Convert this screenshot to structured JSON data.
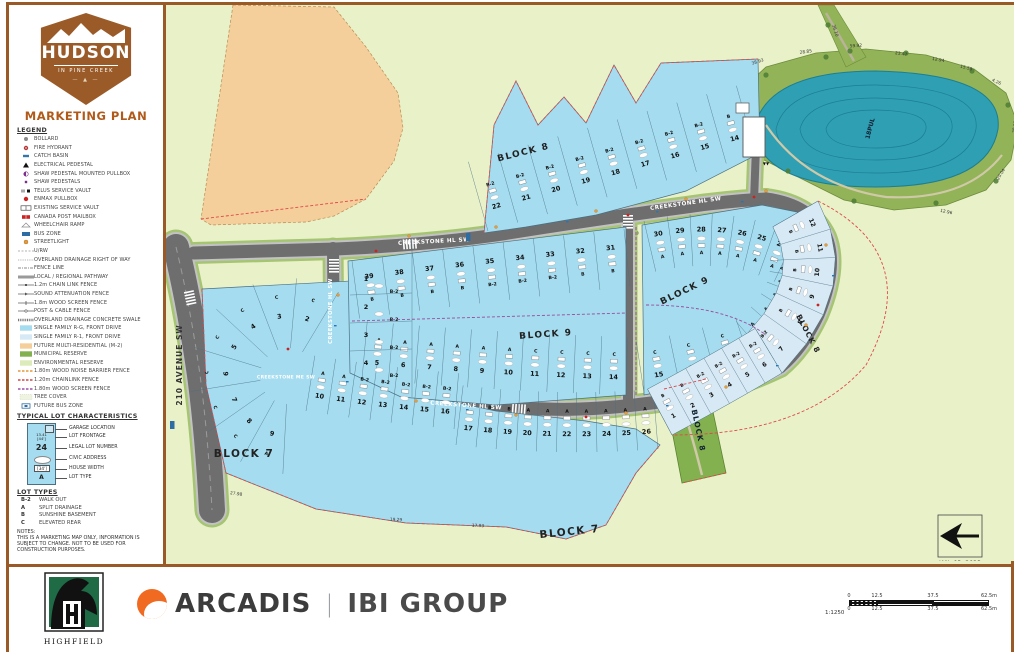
{
  "title_block": {
    "logo_name": "HUDSON",
    "logo_tagline": "IN PINE CREEK",
    "logo_est": "EST&nbsp; 2018",
    "plan_title": "MARKETING PLAN"
  },
  "colors": {
    "frame": "#9a5a28",
    "accent_title": "#b05a1a",
    "badge": "#9a5b28",
    "r_g_lot": "#a5dcef",
    "r_1_lot": "#d6e9f4",
    "m2_future": "#f4cf9b",
    "municipal_reserve": "#84b150",
    "environmental_reserve": "#e9f1c9",
    "pond_water": "#2f9fb4",
    "pond_ring": "#92b357",
    "road": "#6e6e6e",
    "fence_red": "#e04848",
    "fence_purple": "#9a4d9e",
    "bus_blue": "#2e6da4",
    "streetlight": "#e39b3d"
  },
  "legend": {
    "heading": "LEGEND",
    "items": [
      {
        "icon": "bollard-icon",
        "label": "BOLLARD"
      },
      {
        "icon": "fire-hydrant-icon",
        "label": "FIRE HYDRANT"
      },
      {
        "icon": "catch-basin-icon",
        "label": "CATCH BASIN"
      },
      {
        "icon": "electrical-pedestal-icon",
        "label": "ELECTRICAL PEDESTAL"
      },
      {
        "icon": "shaw-pullbox-icon",
        "label": "SHAW PEDESTAL MOUNTED PULLBOX"
      },
      {
        "icon": "shaw-pedestal-icon",
        "label": "SHAW PEDESTALS"
      },
      {
        "icon": "telus-vault-icon",
        "label": "TELUS SERVICE VAULT"
      },
      {
        "icon": "enmax-pullbox-icon",
        "label": "ENMAX PULLBOX"
      },
      {
        "icon": "existing-vault-icon",
        "label": "EXISTING SERVICE VAULT"
      },
      {
        "icon": "canada-post-icon",
        "label": "CANADA POST MAILBOX"
      },
      {
        "icon": "wheelchair-ramp-icon",
        "label": "WHEELCHAIR RAMP"
      },
      {
        "icon": "bus-zone-icon",
        "label": "BUS ZONE"
      },
      {
        "icon": "streetlight-icon",
        "label": "STREETLIGHT"
      },
      {
        "icon": "urw-line-icon",
        "label": "U/RW"
      },
      {
        "icon": "overland-drainage-icon",
        "label": "OVERLAND DRAINAGE RIGHT OF WAY"
      },
      {
        "icon": "fence-line-icon",
        "label": "FENCE LINE"
      },
      {
        "icon": "pathway-icon",
        "label": "LOCAL / REGIONAL PATHWAY"
      },
      {
        "icon": "chain-link-fence-icon",
        "label": "1.2m CHAIN LINK FENCE"
      },
      {
        "icon": "sound-fence-icon",
        "label": "SOUND ATTENUATION FENCE"
      },
      {
        "icon": "wood-screen-fence-icon",
        "label": "1.8m WOOD SCREEN FENCE"
      },
      {
        "icon": "post-cable-fence-icon",
        "label": "POST & CABLE FENCE"
      },
      {
        "icon": "concrete-swale-icon",
        "label": "OVERLAND DRAINAGE CONCRETE SWALE"
      },
      {
        "icon": "swatch-rg",
        "label": "SINGLE FAMILY R-G, FRONT DRIVE"
      },
      {
        "icon": "swatch-r1",
        "label": "SINGLE FAMILY R-1, FRONT DRIVE"
      },
      {
        "icon": "swatch-m2",
        "label": "FUTURE MULTI-RESIDENTIAL (M-2)"
      },
      {
        "icon": "swatch-mr",
        "label": "MUNICIPAL RESERVE"
      },
      {
        "icon": "swatch-er",
        "label": "ENVIRONMENTAL RESERVE"
      },
      {
        "icon": "noise-barrier-icon",
        "label": "1.80m WOOD NOISE BARRIER FENCE"
      },
      {
        "icon": "chainlink-120-icon",
        "label": "1.20m CHAINLINK FENCE"
      },
      {
        "icon": "wood-screen-180-icon",
        "label": "1.80m WOOD SCREEN FENCE"
      },
      {
        "icon": "tree-cover-icon",
        "label": "TREE COVER"
      },
      {
        "icon": "future-bus-icon",
        "label": "FUTURE BUS ZONE"
      }
    ]
  },
  "typical_lot": {
    "heading": "TYPICAL LOT CHARACTERISTICS",
    "sample": {
      "frontage": "13.41",
      "frontage_ft": "[44']",
      "lot_number": "24",
      "width": "[34']",
      "type": "A"
    },
    "callouts": [
      "GARAGE LOCATION",
      "LOT FRONTAGE",
      "LEGAL LOT NUMBER",
      "CIVIC ADDRESS",
      "HOUSE WIDTH",
      "LOT TYPE"
    ]
  },
  "lot_types": {
    "heading": "LOT TYPES",
    "items": [
      {
        "code": "B-2",
        "label": "WALK OUT"
      },
      {
        "code": "A",
        "label": "SPLIT DRAINAGE"
      },
      {
        "code": "B",
        "label": "SUNSHINE BASEMENT"
      },
      {
        "code": "C",
        "label": "ELEVATED REAR"
      }
    ]
  },
  "notes": {
    "heading": "NOTES:",
    "text": "THIS IS A MARKETING MAP ONLY, INFORMATION IS SUBJECT TO CHANGE. NOT TO BE USED FOR CONSTRUCTION PURPOSES."
  },
  "footer": {
    "highfield": "HIGHFIELD",
    "arcadis": "ARCADIS",
    "divider": "|",
    "ibi": "IBI GROUP",
    "scale_ratio": "1:1250",
    "scale_ticks": [
      "0",
      "12.5",
      "37.5",
      "62.5m"
    ]
  },
  "map": {
    "date": "JAN. 03, 2023",
    "streets": {
      "hl": "CREEKSTONE HL SW",
      "me": "CREEKSTONE ME SW",
      "ave": "210 AVENUE SW"
    },
    "pond_label": "18PUL",
    "dims": [
      "38.93",
      "28.85",
      "59.92",
      "23.47",
      "12.94",
      "15.58",
      "4.26",
      "28.92",
      "20.04",
      "12.96",
      "36.10",
      "27.98",
      "19.29",
      "17.93"
    ],
    "blocks": {
      "block7": {
        "label": "BLOCK 7"
      },
      "block8": {
        "label": "BLOCK 8"
      },
      "block9": {
        "label": "BLOCK 9"
      }
    },
    "lots": {
      "b7_radial": [
        {
          "n": "2",
          "t": "C"
        },
        {
          "n": "3",
          "t": "C"
        },
        {
          "n": "4",
          "t": "C"
        },
        {
          "n": "5",
          "t": "C"
        },
        {
          "n": "6",
          "t": "C"
        },
        {
          "n": "7",
          "t": "C"
        },
        {
          "n": "8",
          "t": "C"
        },
        {
          "n": "9",
          "t": "A"
        }
      ],
      "b7_mid": [
        {
          "n": "10",
          "t": "A"
        },
        {
          "n": "11",
          "t": "A"
        },
        {
          "n": "12",
          "t": "B-2"
        },
        {
          "n": "13",
          "t": "B-2"
        },
        {
          "n": "14",
          "t": "B-2"
        },
        {
          "n": "15",
          "t": "B-2"
        },
        {
          "n": "16",
          "t": "B-2"
        }
      ],
      "b7_south": [
        {
          "n": "17",
          "t": "B"
        },
        {
          "n": "18",
          "t": "B"
        },
        {
          "n": "19",
          "t": "B"
        },
        {
          "n": "20",
          "t": "A"
        },
        {
          "n": "21",
          "t": "A"
        },
        {
          "n": "22",
          "t": "A"
        },
        {
          "n": "23",
          "t": "A"
        },
        {
          "n": "24",
          "t": "A"
        },
        {
          "n": "25",
          "t": "A"
        },
        {
          "n": "26",
          "t": "A"
        }
      ],
      "b9_west_col": [
        {
          "n": "1",
          "t": "B-2"
        },
        {
          "n": "2",
          "t": "B-2"
        },
        {
          "n": "3",
          "t": "B-2"
        },
        {
          "n": "4",
          "t": "B-2"
        }
      ],
      "b9_west_top": [
        {
          "n": "39",
          "t": "B"
        },
        {
          "n": "38",
          "t": "B"
        },
        {
          "n": "37",
          "t": "B"
        },
        {
          "n": "36",
          "t": "B"
        },
        {
          "n": "35",
          "t": "B-2"
        },
        {
          "n": "34",
          "t": "B-2"
        },
        {
          "n": "33",
          "t": "B-2"
        },
        {
          "n": "32",
          "t": "B"
        },
        {
          "n": "31",
          "t": "B"
        }
      ],
      "b9_west_bot": [
        {
          "n": "5",
          "t": "A"
        },
        {
          "n": "6",
          "t": "A"
        },
        {
          "n": "7",
          "t": "A"
        },
        {
          "n": "8",
          "t": "A"
        },
        {
          "n": "9",
          "t": "A"
        },
        {
          "n": "10",
          "t": "A"
        },
        {
          "n": "11",
          "t": "C"
        },
        {
          "n": "12",
          "t": "C"
        },
        {
          "n": "13",
          "t": "C"
        },
        {
          "n": "14",
          "t": "C"
        }
      ],
      "b9_east_top": [
        {
          "n": "30",
          "t": "A"
        },
        {
          "n": "29",
          "t": "A"
        },
        {
          "n": "28",
          "t": "A"
        },
        {
          "n": "27",
          "t": "A"
        },
        {
          "n": "26",
          "t": "A"
        },
        {
          "n": "25",
          "t": "A"
        },
        {
          "n": "24",
          "t": "A"
        },
        {
          "n": "23",
          "t": "A"
        }
      ],
      "b9_east_col": [
        {
          "n": "22",
          "t": "A"
        },
        {
          "n": "21",
          "t": "A"
        },
        {
          "n": "20",
          "t": "A"
        },
        {
          "n": "19",
          "t": "A"
        },
        {
          "n": "18",
          "t": "A"
        }
      ],
      "b9_east_bot": [
        {
          "n": "15",
          "t": "C"
        },
        {
          "n": "16",
          "t": "C"
        },
        {
          "n": "17",
          "t": "C"
        }
      ],
      "b8_top": [
        {
          "n": "22",
          "t": "B-2"
        },
        {
          "n": "21",
          "t": "B-2"
        },
        {
          "n": "20",
          "t": "B-2"
        },
        {
          "n": "19",
          "t": "B-2"
        },
        {
          "n": "18",
          "t": "B-2"
        },
        {
          "n": "17",
          "t": "B-2"
        },
        {
          "n": "16",
          "t": "B-2"
        },
        {
          "n": "15",
          "t": "B-2"
        },
        {
          "n": "14",
          "t": "B"
        }
      ],
      "b8_arc_ne": [
        {
          "n": "12",
          "t": "B"
        },
        {
          "n": "11",
          "t": "B"
        },
        {
          "n": "10",
          "t": "B"
        },
        {
          "n": "9",
          "t": "B"
        },
        {
          "n": "8",
          "t": "B"
        },
        {
          "n": "7",
          "t": "B-2"
        }
      ],
      "b8_arc_s": [
        {
          "n": "6",
          "t": "B-2"
        },
        {
          "n": "5",
          "t": "B-2"
        },
        {
          "n": "4",
          "t": "B-2"
        },
        {
          "n": "3",
          "t": "B-2"
        },
        {
          "n": "2",
          "t": "B"
        },
        {
          "n": "1",
          "t": "B"
        }
      ]
    }
  }
}
